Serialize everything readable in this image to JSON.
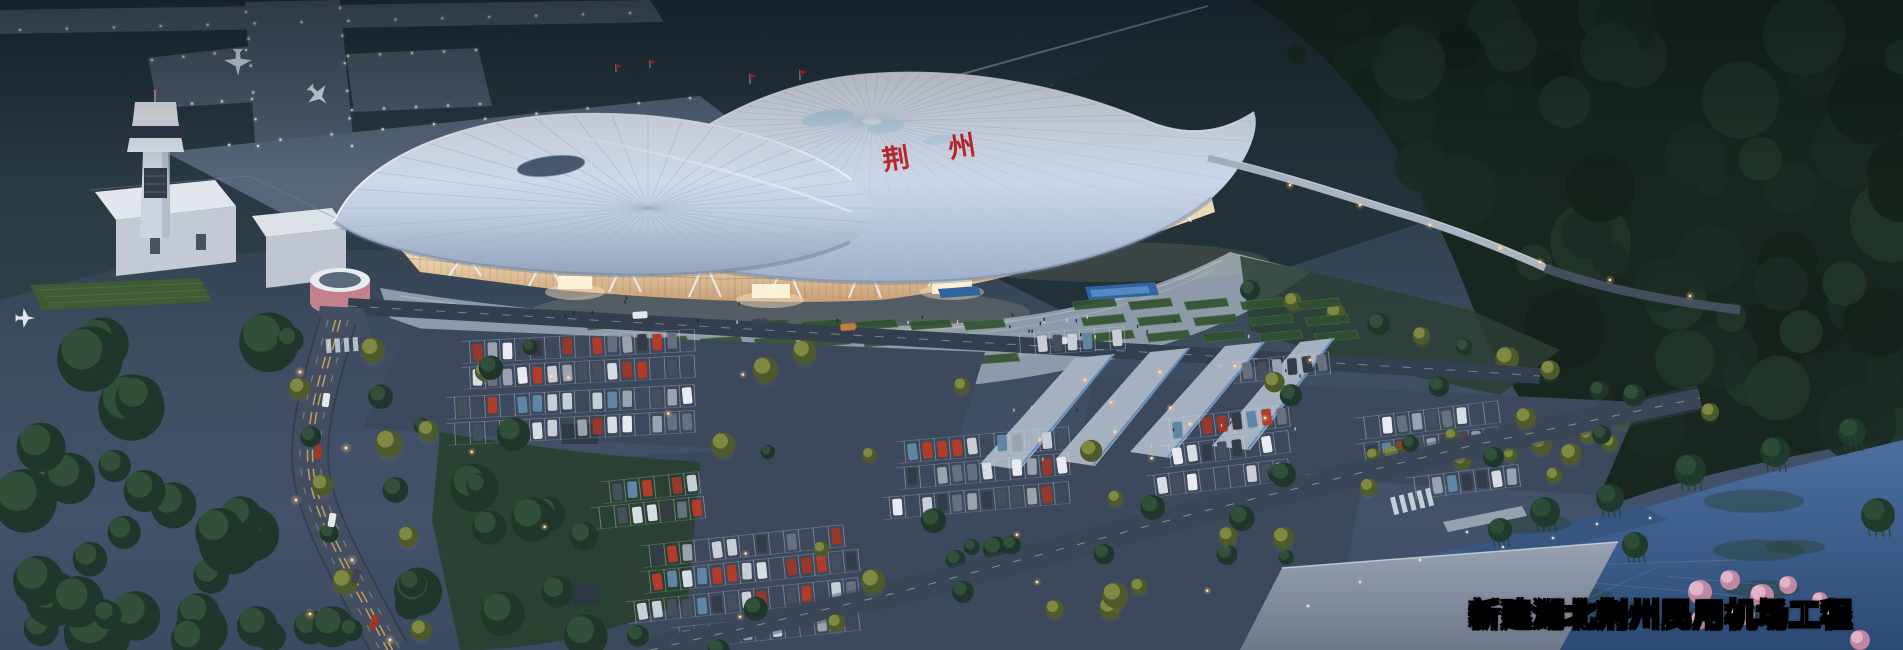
{
  "scene": {
    "type": "aerial night rendering of a new airport terminal",
    "caption": "新建湖北荆州民用机场工程",
    "roof_sign": {
      "char1": "荆",
      "char2": "州"
    }
  },
  "colors": {
    "accent_red": "#c2272d",
    "caption_text": "#ffffff",
    "caption_outline": "#000000",
    "roof_light": "#eef3fa",
    "roof_shade": "#9fb0ca",
    "facade_warm": "#f4dfbc",
    "facade_deep": "#caa076",
    "pavement": "#8e9aa9",
    "asphalt": "#3c485b",
    "road": "#434f60",
    "taxiway": "#4e5c6d",
    "grass_dark": "#263731",
    "forest": "#18261f",
    "lake": "#3f639a",
    "lamp_glow": "#ffc87a",
    "tree_lit": "#8a9247"
  }
}
